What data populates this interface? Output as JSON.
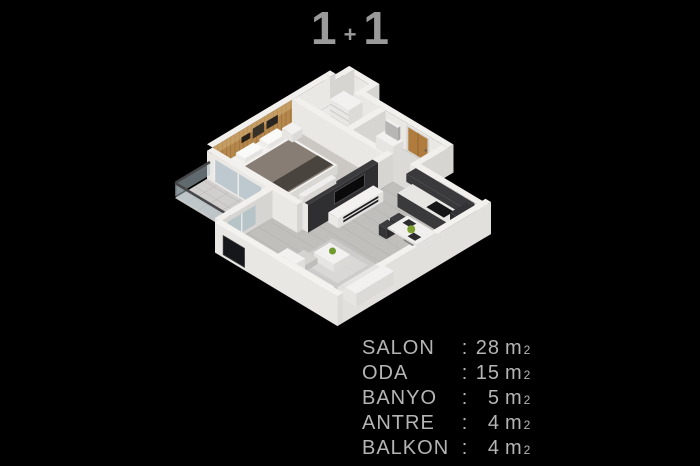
{
  "title": {
    "left": "1",
    "plus": "+",
    "right": "1"
  },
  "legend": {
    "colon": ":",
    "unit": "m",
    "sup": "2",
    "rows": [
      {
        "name": "SALON",
        "value": "28"
      },
      {
        "name": "ODA",
        "value": "15"
      },
      {
        "name": "BANYO",
        "value": "5"
      },
      {
        "name": "ANTRE",
        "value": "4"
      },
      {
        "name": "BALKON",
        "value": "4"
      }
    ]
  },
  "palette": {
    "background": "#000000",
    "title_text": "#9a9a9a",
    "legend_text": "#b5b5b5",
    "wall_top": "#f2f0ed",
    "wall_face_right": "#d7d5d2",
    "wall_face_left": "#eae8e5",
    "wall_exterior_bright": "#e9e7e4",
    "floor_salon": "#c1bfbc",
    "floor_bedroom": "#cbc7c2",
    "floor_bath": "#eae9e7",
    "floor_antre": "#dcdad7",
    "floor_balcony": "#d0cfce",
    "wood_wall": "#b5874c",
    "wood_door": "#b07c3e",
    "dark_wall": "#2f2f31",
    "dark_furniture": "#2b2b2d",
    "white_furniture": "#f2f1ef",
    "glass": "#aebfc6",
    "plant_green": "#7da02e",
    "duvet": "#877d74",
    "throw_dark": "#4a443f",
    "rug": "#dcdad7"
  }
}
